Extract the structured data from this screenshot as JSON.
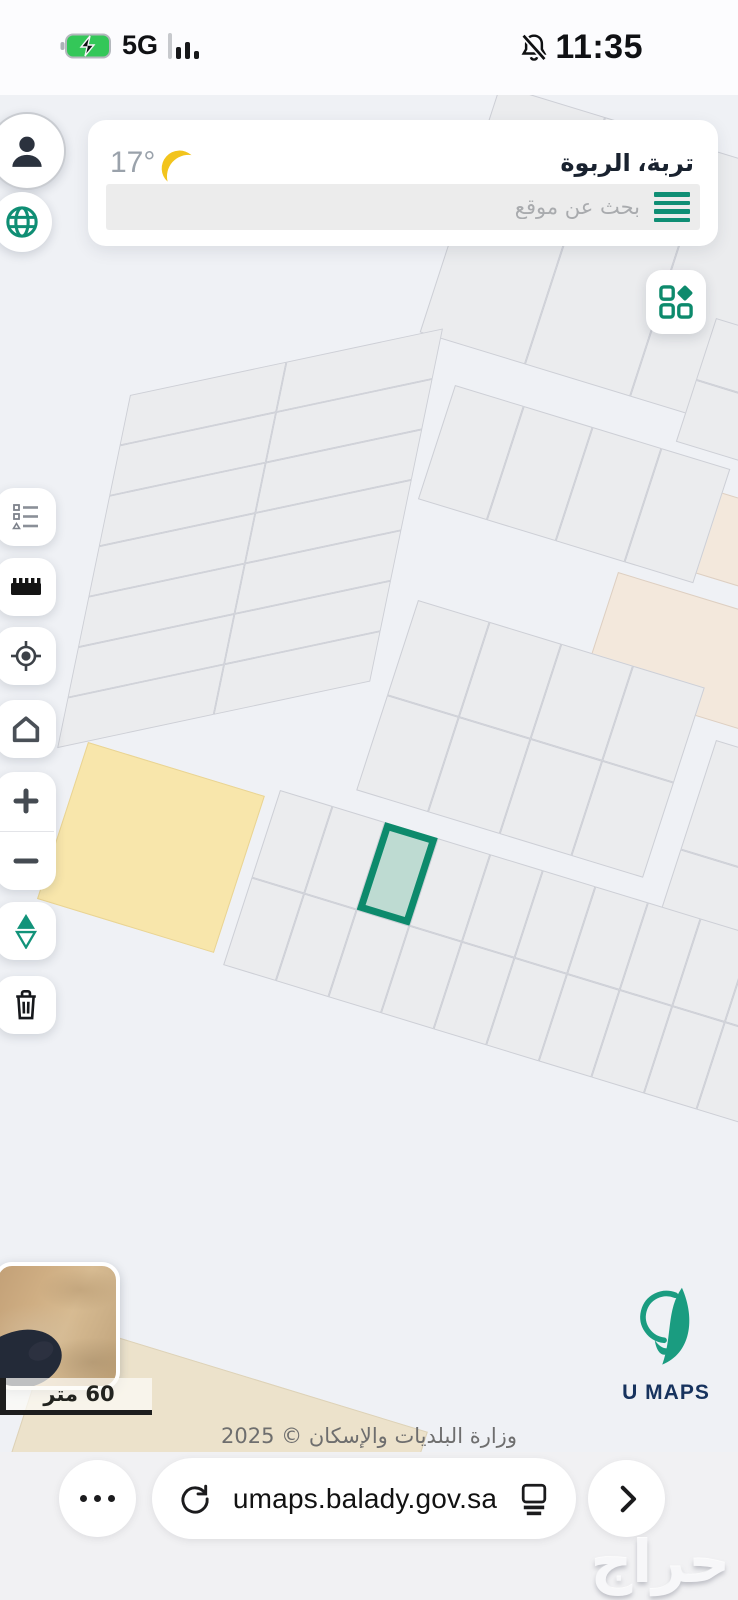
{
  "status_bar": {
    "time": "11:35",
    "network": "5G"
  },
  "header": {
    "location_title": "تربة، الربوة",
    "temperature": "17°",
    "search_placeholder": "بحث عن موقع"
  },
  "map": {
    "scale_label": "60 متر",
    "attribution": "وزارة البلديات والإسكان © 2025"
  },
  "logo": {
    "text": "U MAPS"
  },
  "browser": {
    "url": "umaps.balady.gov.sa"
  },
  "watermark": {
    "text": "حراج"
  },
  "colors": {
    "accent_teal": "#0f8e74",
    "highlight_stroke": "#0d8a6c",
    "highlight_fill": "#bedbd2",
    "parcel": "#ebecee",
    "parcel_border": "#cdcfd6",
    "road_bg": "#eff1f5",
    "beige_parcel": "#f3e8dc",
    "yellow_parcel": "#f8e6ab",
    "moon_yellow": "#f2c41d",
    "battery_green": "#34c759",
    "logo_navy": "#17335e"
  }
}
